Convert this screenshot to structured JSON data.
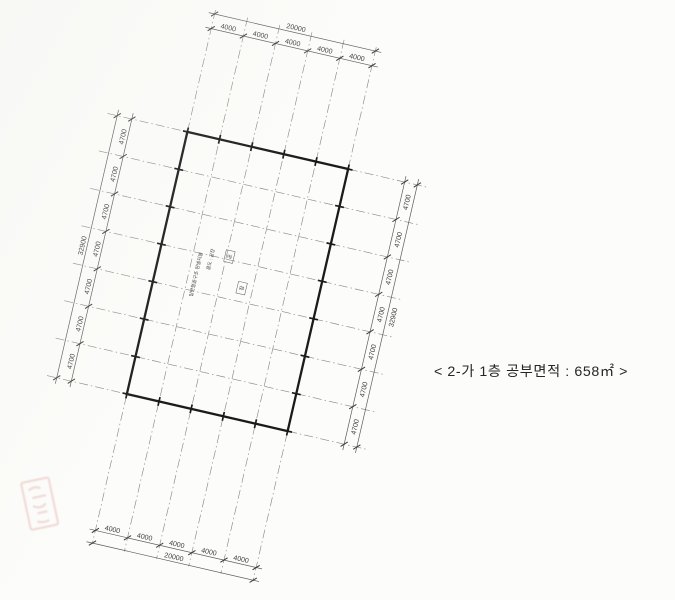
{
  "caption": {
    "text": "< 2-가 1층 공부면적 : 658㎡ >"
  },
  "plan": {
    "rotation_deg": 13,
    "dimensions": {
      "top": {
        "total": "20000",
        "segments": [
          "4000",
          "4000",
          "4000",
          "4000",
          "4000"
        ]
      },
      "bottom": {
        "total": "20000",
        "segments": [
          "4000",
          "4000",
          "4000",
          "4000",
          "4000"
        ]
      },
      "left": {
        "total": "32900",
        "segments": [
          "4700",
          "4700",
          "4700",
          "4700",
          "4700",
          "4700",
          "4700"
        ]
      },
      "right": {
        "total": "32900",
        "segments": [
          "4700",
          "4700",
          "4700",
          "4700",
          "4700",
          "4700",
          "4700"
        ]
      }
    },
    "center_label": {
      "line1": "일반철골구조 판넬지붕",
      "line2": "용도 : 공장",
      "boxed": [
        "공",
        "장"
      ]
    }
  },
  "colors": {
    "outline": "#1b1b1b",
    "grid": "#8a8a8a",
    "chain": "#5c5c5c",
    "tick": "#3a3a3a",
    "dim_text": "#3c3c3c",
    "stamp": "#c0392b"
  }
}
